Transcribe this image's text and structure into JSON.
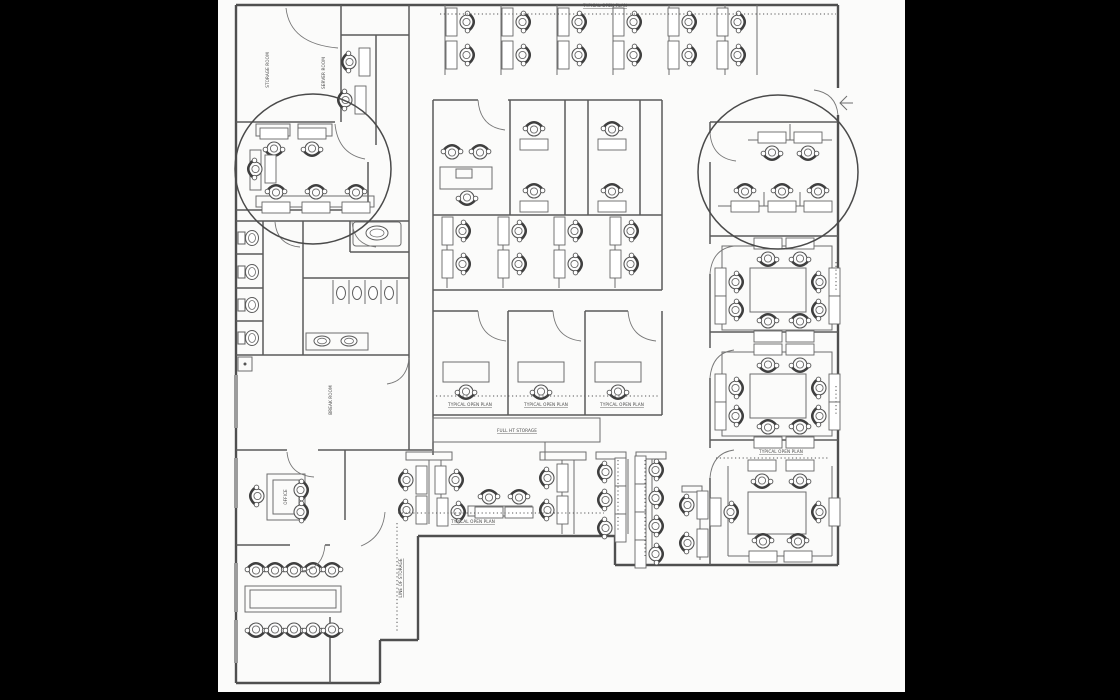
{
  "scene": {
    "background": "#000000",
    "page_background": "#fbfbfa",
    "ink": "#4f4f4f"
  },
  "floorplan": {
    "annotation_circles": [
      {
        "cx": 313,
        "cy": 169,
        "rx": 78,
        "ry": 75
      },
      {
        "cx": 778,
        "cy": 172,
        "rx": 80,
        "ry": 77
      }
    ],
    "labels": [
      {
        "t": "STORAGE ROOM",
        "x": 269,
        "y": 70,
        "r": -90
      },
      {
        "t": "SERVER ROOM",
        "x": 325,
        "y": 73,
        "r": -90
      },
      {
        "t": "TYPICAL OPEN PLAN",
        "x": 605,
        "y": 7,
        "u": true
      },
      {
        "t": "TYPICAL OPEN PLAN",
        "x": 470,
        "y": 406,
        "u": true
      },
      {
        "t": "TYPICAL OPEN PLAN",
        "x": 546,
        "y": 406,
        "u": true
      },
      {
        "t": "TYPICAL OPEN PLAN",
        "x": 622,
        "y": 406,
        "u": true
      },
      {
        "t": "FULL HT STORAGE",
        "x": 517,
        "y": 432,
        "u": true
      },
      {
        "t": "TYPICAL OPEN PLAN",
        "x": 473,
        "y": 523,
        "u": true
      },
      {
        "t": "TYPICAL OPEN PLAN",
        "x": 781,
        "y": 453,
        "u": true
      },
      {
        "t": "LINE OF STORAGE",
        "x": 402,
        "y": 578,
        "r": -90,
        "u": true
      },
      {
        "t": "OFFICE",
        "x": 287,
        "y": 497,
        "r": -90
      },
      {
        "t": "BREAK ROOM",
        "x": 332,
        "y": 400,
        "r": -90
      }
    ],
    "walls_outer": [
      "M236,5 H838",
      "M838,5 V88",
      "M838,115 V565",
      "M838,565 H615",
      "M615,565 V536",
      "M615,536 H418",
      "M418,536 V640",
      "M418,640 H380",
      "M380,640 V683",
      "M380,683 H236",
      "M236,683 V5"
    ],
    "walls_inner": [
      "M341,5 V122",
      "M409,5 V450",
      "M341,35 H409",
      "M376,35 V145",
      "M236,122 H335",
      "M368,162 V210",
      "M236,210 H368",
      "M236,221 H409",
      "M263,221 V355",
      "M236,254 H263",
      "M236,288 H263",
      "M236,321 H263",
      "M303,221 V355",
      "M350,221 V252",
      "M350,252 H409",
      "M303,278 H409",
      "M236,355 H409",
      "M236,450 H287",
      "M318,450 H432",
      "M345,450 V520",
      "M236,545 H290",
      "M325,545 H330",
      "M330,617 V683",
      "M433,100 V455",
      "M433,100 H478",
      "M508,100 H662",
      "M662,100 V290",
      "M510,100 V215",
      "M565,100 V215",
      "M588,100 V215",
      "M640,100 V215",
      "M433,215 H662",
      "M433,290 H662",
      "M433,311 H478",
      "M508,311 H553",
      "M585,311 H628",
      "M508,311 V415",
      "M585,311 V415",
      "M662,311 V415",
      "M433,415 H662",
      "M710,122 H838",
      "M710,122 V133",
      "M710,162 V244",
      "M710,274 V348",
      "M710,378 V448",
      "M710,478 V565",
      "M710,236 H838",
      "M710,332 H838",
      "M710,440 H838"
    ],
    "partitions": [
      "M445,5 V75",
      "M501,5 V75",
      "M557,5 V75",
      "M613,5 V75",
      "M669,5 V75",
      "M725,5 V75",
      "M757,5 V75",
      "M447,218 V288",
      "M503,218 V288",
      "M559,218 V288",
      "M615,218 V288",
      "M333,280 V304",
      "M349,280 V304",
      "M365,280 V304",
      "M381,280 V304",
      "M397,280 V304",
      "M748,140 H832",
      "M718,206 H832",
      "M790,124 V140",
      "M764,192 V206",
      "M800,192 V206",
      "M615,459 V534",
      "M628,459 V534",
      "M641,459 V560",
      "M652,459 V560",
      "M700,492 V560",
      "M429,460 V524",
      "M441,460 V524",
      "M562,460 V534",
      "M574,460 V534",
      "M545,442 V460",
      "M728,466 V556",
      "M728,556 H832",
      "M832,466 V556"
    ],
    "rects": [
      {
        "x": 433,
        "y": 418,
        "w": 167,
        "h": 24,
        "n": "storage-cabinet"
      },
      {
        "x": 443,
        "y": 362,
        "w": 46,
        "h": 20,
        "n": "desk"
      },
      {
        "x": 518,
        "y": 362,
        "w": 46,
        "h": 20,
        "n": "desk"
      },
      {
        "x": 595,
        "y": 362,
        "w": 46,
        "h": 20,
        "n": "desk"
      },
      {
        "x": 267,
        "y": 474,
        "w": 38,
        "h": 46,
        "n": "desk"
      },
      {
        "x": 273,
        "y": 480,
        "w": 26,
        "h": 34,
        "n": "desk-inner"
      },
      {
        "x": 245,
        "y": 586,
        "w": 96,
        "h": 26,
        "n": "conference-table"
      },
      {
        "x": 250,
        "y": 590,
        "w": 86,
        "h": 18,
        "n": "conference-table-inner"
      },
      {
        "x": 440,
        "y": 167,
        "w": 52,
        "h": 22,
        "n": "counter"
      },
      {
        "x": 456,
        "y": 169,
        "w": 16,
        "h": 9,
        "n": "copier"
      },
      {
        "x": 353,
        "y": 222,
        "w": 48,
        "h": 24,
        "rx": 3,
        "n": "vanity"
      },
      {
        "x": 306,
        "y": 333,
        "w": 62,
        "h": 17,
        "n": "sink-counter"
      },
      {
        "x": 238,
        "y": 357,
        "w": 14,
        "h": 14,
        "n": "column"
      },
      {
        "x": 256,
        "y": 124,
        "w": 34,
        "h": 12,
        "n": "desk-band"
      },
      {
        "x": 298,
        "y": 124,
        "w": 34,
        "h": 12,
        "n": "desk-band"
      },
      {
        "x": 250,
        "y": 150,
        "w": 11,
        "h": 40,
        "n": "desk-band"
      },
      {
        "x": 256,
        "y": 196,
        "w": 118,
        "h": 11,
        "n": "desk-band"
      },
      {
        "x": 722,
        "y": 246,
        "w": 110,
        "h": 84,
        "n": "pod-partition"
      },
      {
        "x": 750,
        "y": 268,
        "w": 56,
        "h": 44,
        "n": "pod-core"
      },
      {
        "x": 722,
        "y": 352,
        "w": 110,
        "h": 84,
        "n": "pod-partition"
      },
      {
        "x": 750,
        "y": 374,
        "w": 56,
        "h": 44,
        "n": "pod-core"
      },
      {
        "x": 748,
        "y": 492,
        "w": 58,
        "h": 42,
        "n": "pod-core"
      },
      {
        "x": 596,
        "y": 452,
        "w": 30,
        "h": 7,
        "n": "partition-cap"
      },
      {
        "x": 636,
        "y": 452,
        "w": 30,
        "h": 7,
        "n": "partition-cap"
      },
      {
        "x": 682,
        "y": 486,
        "w": 20,
        "h": 6,
        "n": "partition-cap"
      },
      {
        "x": 406,
        "y": 452,
        "w": 46,
        "h": 8,
        "n": "partition-cap"
      },
      {
        "x": 540,
        "y": 452,
        "w": 46,
        "h": 8,
        "n": "partition-cap"
      },
      {
        "x": 468,
        "y": 506,
        "w": 64,
        "h": 10,
        "n": "desk-band"
      }
    ],
    "doors": [
      "M286,8 Q290,44 338,48",
      "M335,124 Q338,154 365,159",
      "M478,100 Q480,127 505,130",
      "M478,311 Q480,338 506,341",
      "M553,311 Q555,338 581,341",
      "M628,311 Q630,338 656,341",
      "M710,133 Q712,158 736,161",
      "M710,274 Q712,249 734,246",
      "M710,378 Q712,353 734,350",
      "M710,478 Q712,453 734,450",
      "M838,115 Q836,93 814,90",
      "M287,452 Q289,475 314,477",
      "M352,222 Q354,245 376,247",
      "M275,222 Q277,245 300,247",
      "M409,358 Q407,381 387,384",
      "M385,512 Q383,537 361,546",
      "M325,545 Q323,568 303,571"
    ],
    "entry_arrow": [
      "M847,96 L840,103 L847,110",
      "M840,103 H853"
    ],
    "dotted": [
      "M440,14 H836",
      "M436,396 H658",
      "M398,513 H604",
      "M716,458 H830",
      "M397,523 V633",
      "M618,460 V532",
      "M645,460 V556",
      "M836,262 V292",
      "M836,386 V414"
    ],
    "windows": [
      "M236,375 V428",
      "M236,458 V508",
      "M236,563 V612",
      "M236,620 V663"
    ],
    "workstations": [
      {
        "x": 466,
        "y": 22,
        "r": 270
      },
      {
        "x": 466,
        "y": 55,
        "r": 270
      },
      {
        "x": 522,
        "y": 22,
        "r": 270
      },
      {
        "x": 522,
        "y": 55,
        "r": 270
      },
      {
        "x": 578,
        "y": 22,
        "r": 270
      },
      {
        "x": 578,
        "y": 55,
        "r": 270
      },
      {
        "x": 633,
        "y": 22,
        "r": 270
      },
      {
        "x": 633,
        "y": 55,
        "r": 270
      },
      {
        "x": 688,
        "y": 22,
        "r": 270
      },
      {
        "x": 688,
        "y": 55,
        "r": 270
      },
      {
        "x": 737,
        "y": 22,
        "r": 270
      },
      {
        "x": 737,
        "y": 55,
        "r": 270
      },
      {
        "x": 350,
        "y": 62,
        "r": 90
      },
      {
        "x": 346,
        "y": 100,
        "r": 90
      },
      {
        "x": 274,
        "y": 148,
        "r": 0
      },
      {
        "x": 312,
        "y": 148,
        "r": 0
      },
      {
        "x": 256,
        "y": 169,
        "r": 90
      },
      {
        "x": 276,
        "y": 193,
        "r": 180
      },
      {
        "x": 316,
        "y": 193,
        "r": 180
      },
      {
        "x": 356,
        "y": 193,
        "r": 180
      },
      {
        "x": 534,
        "y": 130,
        "r": 180
      },
      {
        "x": 534,
        "y": 192,
        "r": 180
      },
      {
        "x": 612,
        "y": 130,
        "r": 180
      },
      {
        "x": 612,
        "y": 192,
        "r": 180
      },
      {
        "x": 462,
        "y": 231,
        "r": 270
      },
      {
        "x": 462,
        "y": 264,
        "r": 270
      },
      {
        "x": 518,
        "y": 231,
        "r": 270
      },
      {
        "x": 518,
        "y": 264,
        "r": 270
      },
      {
        "x": 574,
        "y": 231,
        "r": 270
      },
      {
        "x": 574,
        "y": 264,
        "r": 270
      },
      {
        "x": 630,
        "y": 231,
        "r": 270
      },
      {
        "x": 630,
        "y": 264,
        "r": 270
      },
      {
        "x": 772,
        "y": 152,
        "r": 0
      },
      {
        "x": 808,
        "y": 152,
        "r": 0
      },
      {
        "x": 745,
        "y": 192,
        "r": 180
      },
      {
        "x": 782,
        "y": 192,
        "r": 180
      },
      {
        "x": 818,
        "y": 192,
        "r": 180
      },
      {
        "x": 768,
        "y": 258,
        "r": 0
      },
      {
        "x": 800,
        "y": 258,
        "r": 0
      },
      {
        "x": 735,
        "y": 282,
        "r": 270
      },
      {
        "x": 735,
        "y": 310,
        "r": 270
      },
      {
        "x": 820,
        "y": 282,
        "r": 90
      },
      {
        "x": 820,
        "y": 310,
        "r": 90
      },
      {
        "x": 768,
        "y": 322,
        "r": 180
      },
      {
        "x": 800,
        "y": 322,
        "r": 180
      },
      {
        "x": 768,
        "y": 364,
        "r": 0
      },
      {
        "x": 800,
        "y": 364,
        "r": 0
      },
      {
        "x": 735,
        "y": 388,
        "r": 270
      },
      {
        "x": 735,
        "y": 416,
        "r": 270
      },
      {
        "x": 820,
        "y": 388,
        "r": 90
      },
      {
        "x": 820,
        "y": 416,
        "r": 90
      },
      {
        "x": 768,
        "y": 428,
        "r": 180
      },
      {
        "x": 800,
        "y": 428,
        "r": 180
      },
      {
        "x": 762,
        "y": 480,
        "r": 0
      },
      {
        "x": 800,
        "y": 480,
        "r": 0
      },
      {
        "x": 730,
        "y": 512,
        "r": 270
      },
      {
        "x": 820,
        "y": 512,
        "r": 90
      },
      {
        "x": 763,
        "y": 542,
        "r": 180
      },
      {
        "x": 798,
        "y": 542,
        "r": 180
      },
      {
        "x": 606,
        "y": 472,
        "r": 90
      },
      {
        "x": 606,
        "y": 500,
        "r": 90
      },
      {
        "x": 606,
        "y": 528,
        "r": 90
      },
      {
        "x": 655,
        "y": 470,
        "r": 270
      },
      {
        "x": 655,
        "y": 498,
        "r": 270
      },
      {
        "x": 655,
        "y": 526,
        "r": 270
      },
      {
        "x": 655,
        "y": 554,
        "r": 270
      },
      {
        "x": 688,
        "y": 505,
        "r": 90
      },
      {
        "x": 688,
        "y": 543,
        "r": 90
      },
      {
        "x": 407,
        "y": 480,
        "r": 90
      },
      {
        "x": 407,
        "y": 510,
        "r": 90
      },
      {
        "x": 455,
        "y": 480,
        "r": 270
      },
      {
        "x": 457,
        "y": 512,
        "r": 270
      },
      {
        "x": 489,
        "y": 498,
        "r": 180
      },
      {
        "x": 519,
        "y": 498,
        "r": 180
      },
      {
        "x": 548,
        "y": 478,
        "r": 90
      },
      {
        "x": 548,
        "y": 510,
        "r": 90
      }
    ],
    "chairs": [
      {
        "x": 452,
        "y": 153,
        "r": 180
      },
      {
        "x": 480,
        "y": 153,
        "r": 180
      },
      {
        "x": 467,
        "y": 197,
        "r": 0
      },
      {
        "x": 466,
        "y": 391,
        "r": 0
      },
      {
        "x": 541,
        "y": 391,
        "r": 0
      },
      {
        "x": 618,
        "y": 391,
        "r": 0
      },
      {
        "x": 258,
        "y": 496,
        "r": 90
      },
      {
        "x": 300,
        "y": 490,
        "r": 270
      },
      {
        "x": 300,
        "y": 512,
        "r": 270
      },
      {
        "x": 256,
        "y": 571,
        "r": 180
      },
      {
        "x": 275,
        "y": 571,
        "r": 180
      },
      {
        "x": 294,
        "y": 571,
        "r": 180
      },
      {
        "x": 313,
        "y": 571,
        "r": 180
      },
      {
        "x": 332,
        "y": 571,
        "r": 180
      },
      {
        "x": 256,
        "y": 629,
        "r": 0
      },
      {
        "x": 275,
        "y": 629,
        "r": 0
      },
      {
        "x": 294,
        "y": 629,
        "r": 0
      },
      {
        "x": 313,
        "y": 629,
        "r": 0
      },
      {
        "x": 332,
        "y": 629,
        "r": 0
      }
    ],
    "toilets": [
      238,
      272,
      305,
      338
    ],
    "urinals": [
      341,
      357,
      373,
      389
    ],
    "sinks": [
      {
        "cx": 377,
        "cy": 233,
        "rx": 11,
        "ry": 7
      },
      {
        "cx": 377,
        "cy": 233,
        "rx": 7,
        "ry": 4,
        "inner": true
      },
      {
        "cx": 322,
        "cy": 341,
        "rx": 8,
        "ry": 5
      },
      {
        "cx": 322,
        "cy": 341,
        "rx": 4.5,
        "ry": 2.8,
        "inner": true
      },
      {
        "cx": 349,
        "cy": 341,
        "rx": 8,
        "ry": 5
      },
      {
        "cx": 349,
        "cy": 341,
        "rx": 4.5,
        "ry": 2.8,
        "inner": true
      }
    ]
  }
}
